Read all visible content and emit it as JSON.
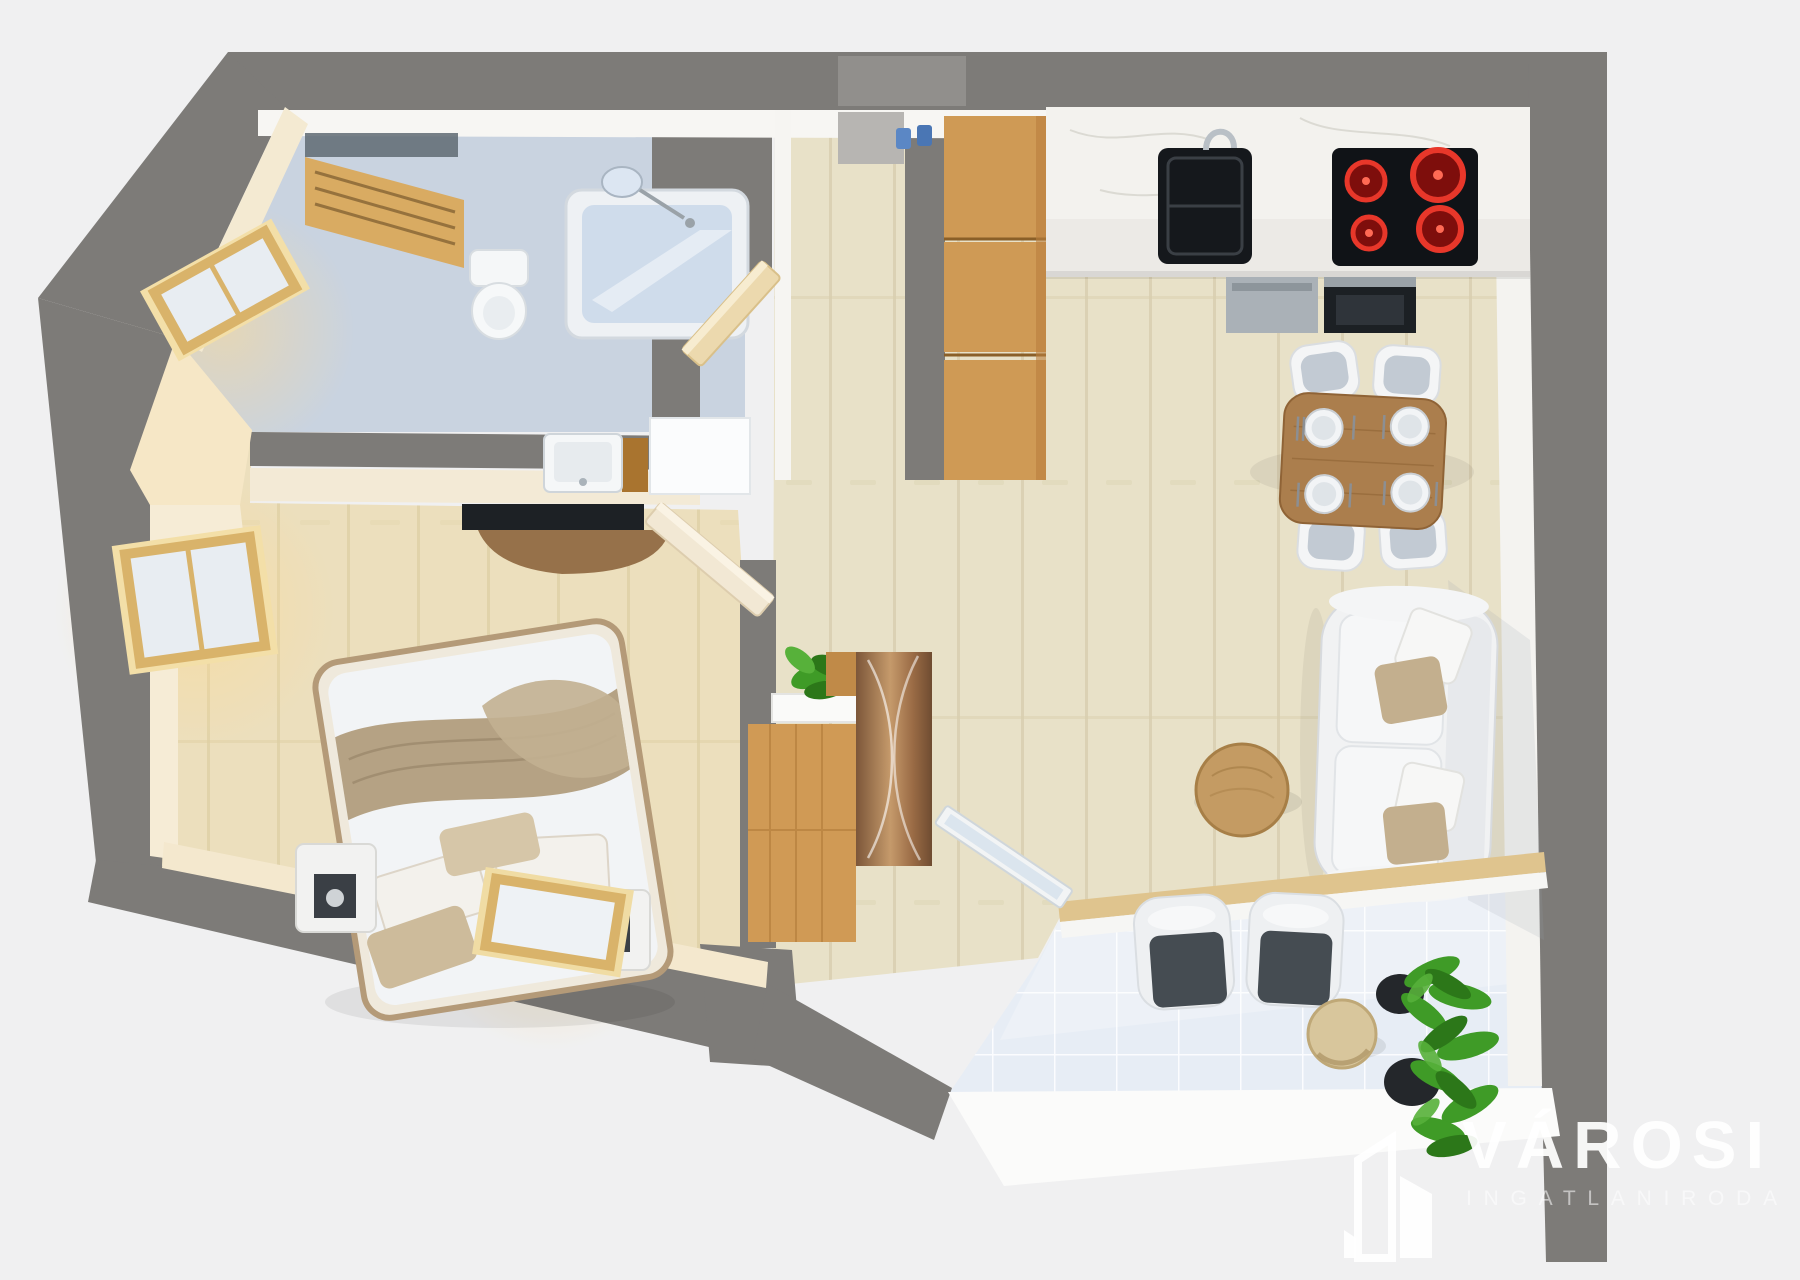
{
  "scene": {
    "type": "3d-floor-plan-render",
    "view": "top-down perspective",
    "description": "Photoreal 3D floor plan of a one-bedroom apartment with balcony"
  },
  "logo": {
    "brand": "VÁROSI",
    "subtitle": "INGATLANIRODA",
    "icon": "buildings-icon"
  },
  "palette": {
    "background": "#f0f0f1",
    "walls": "#7d7b78",
    "wall_inner_face": "#f7f6f3",
    "wall_inner_warm": "#f4e8d2",
    "wood_floor": "#e8e1c8",
    "bedroom_floor": "#ecdfbd",
    "bathroom_floor": "#c9d3e0",
    "balcony_tile": "#eaeef5",
    "cabinet_wood": "#cf9a55",
    "dining_wood": "#ab7e4d",
    "bronze_wardrobe": "#9a6b45",
    "sofa_white": "#f1f2f3",
    "pillow_taupe": "#c3af8e",
    "blanket_tan": "#b5a284",
    "appliance_black": "#15181c",
    "burner_red": "#e8372a",
    "steel": "#a8afb5",
    "window_frame_wood": "#d9b36a",
    "plant_green": "#3f9b27",
    "pot_black": "#24272b"
  },
  "rooms": [
    {
      "name": "bathroom",
      "furniture": [
        "wooden wall shelf",
        "mirror strip",
        "bathtub",
        "shower fixture",
        "toilet",
        "washbasin with wood vanity",
        "wall mirror panel",
        "open wooden door"
      ]
    },
    {
      "name": "entry-hall",
      "furniture": [
        "front door with doormat",
        "blue coat hooks",
        "plant shelf",
        "tall wooden wardrobe",
        "bronze curved-front cabinet"
      ]
    },
    {
      "name": "kitchen",
      "furniture": [
        "tall oak cabinet column",
        "white stone counter",
        "black sink with faucet",
        "induction cooktop with red burners",
        "oven",
        "dishwasher",
        "wood dining table",
        "four white chairs",
        "four place settings"
      ]
    },
    {
      "name": "living-room",
      "furniture": [
        "white sofa with taupe pillows",
        "round wooden coffee table"
      ]
    },
    {
      "name": "bedroom",
      "furniture": [
        "double bed with tan blanket",
        "pillow group",
        "left nightstand with photo",
        "right nightstand with photo",
        "wall TV with curved wood shelf",
        "two side windows",
        "bottom window",
        "open door"
      ]
    },
    {
      "name": "balcony",
      "furniture": [
        "open glass door",
        "wood threshold",
        "two lounge chairs with dark cushions",
        "round side table",
        "potted plants"
      ]
    }
  ]
}
